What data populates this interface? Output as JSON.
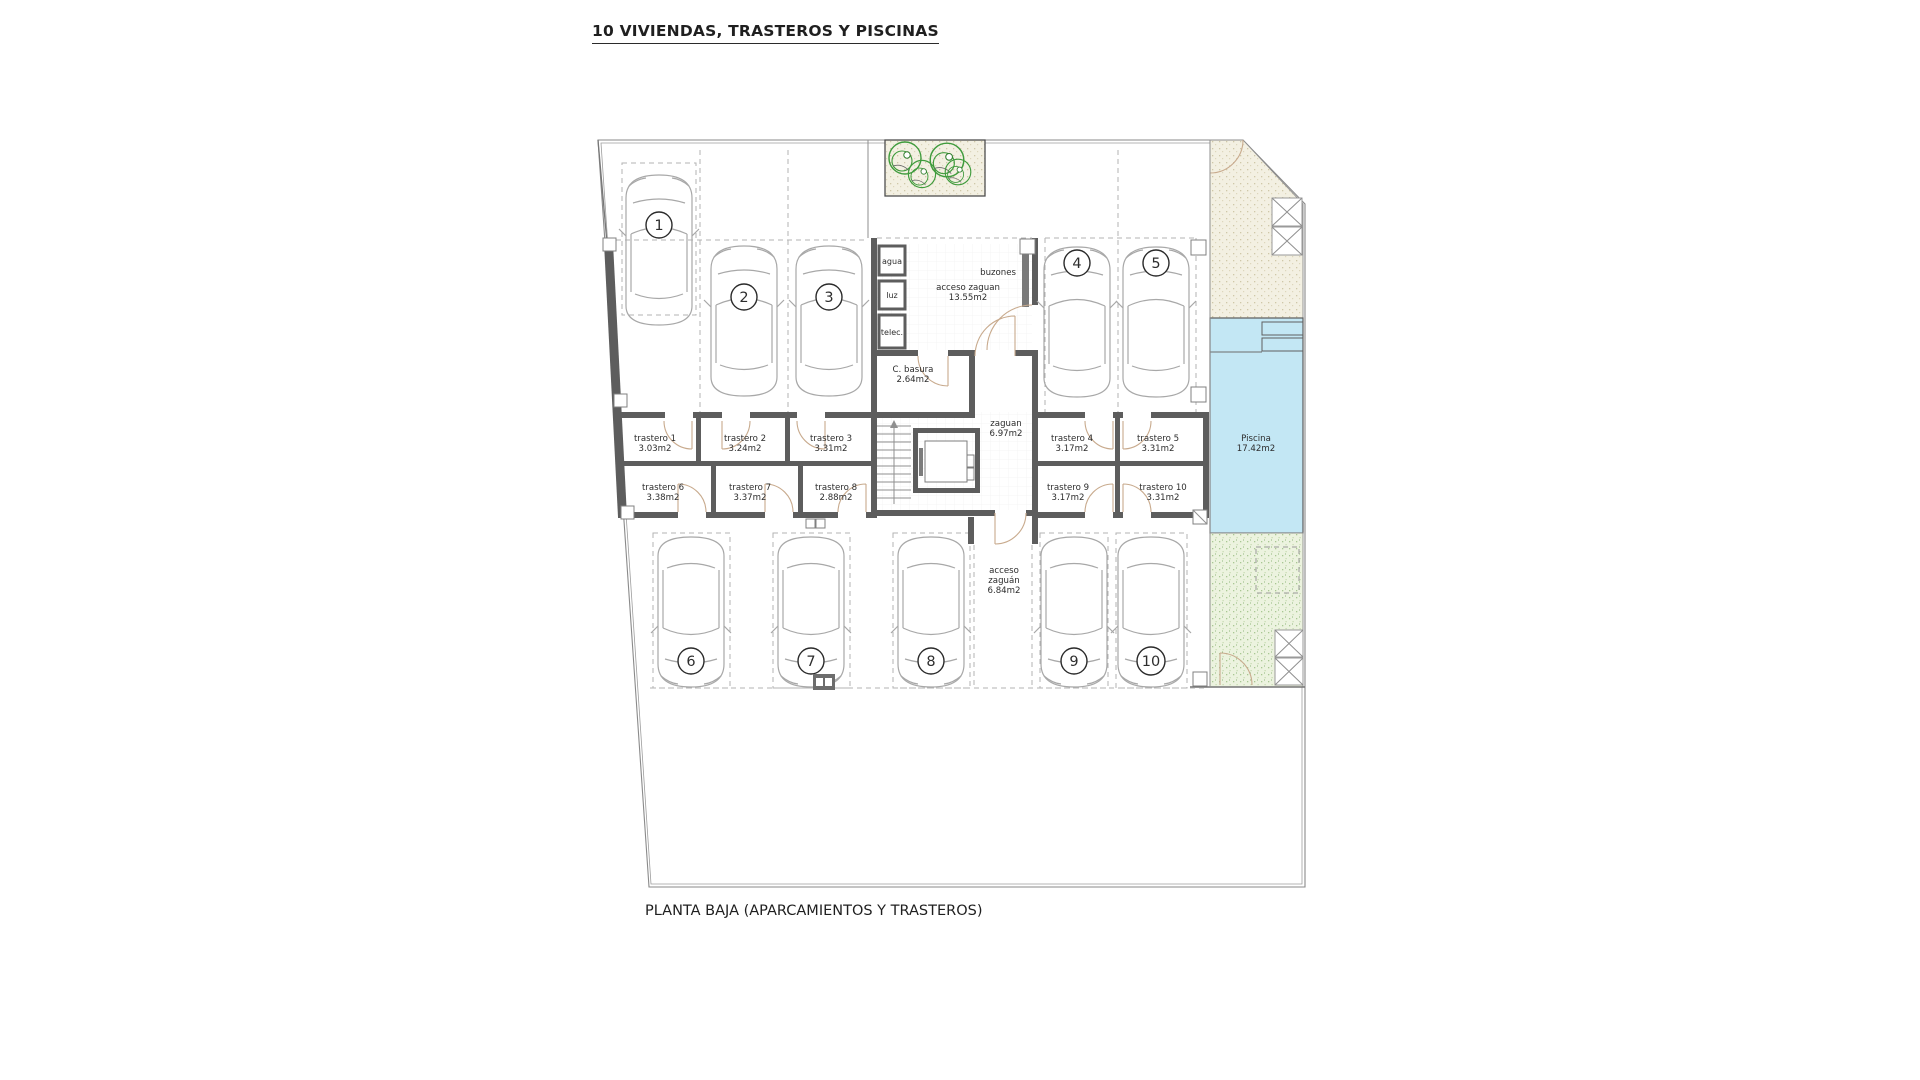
{
  "title": "10 VIVIENDAS, TRASTEROS Y PISCINAS",
  "caption": "PLANTA BAJA (APARCAMIENTOS Y TRASTEROS)",
  "colors": {
    "pool": "#c3e7f4",
    "garden_sand": "#f3f0e2",
    "garden_green": "#ebf2de",
    "wall": "#5d5d5d",
    "door": "#c8aa8d",
    "tree": "#3f9b3c"
  },
  "parking": [
    "1",
    "2",
    "3",
    "4",
    "5",
    "6",
    "7",
    "8",
    "9",
    "10"
  ],
  "trasteros": [
    {
      "name": "trastero 1",
      "area": "3.03m2"
    },
    {
      "name": "trastero 2",
      "area": "3.24m2"
    },
    {
      "name": "trastero 3",
      "area": "3.31m2"
    },
    {
      "name": "trastero 4",
      "area": "3.17m2"
    },
    {
      "name": "trastero 5",
      "area": "3.31m2"
    },
    {
      "name": "trastero 6",
      "area": "3.38m2"
    },
    {
      "name": "trastero 7",
      "area": "3.37m2"
    },
    {
      "name": "trastero 8",
      "area": "2.88m2"
    },
    {
      "name": "trastero 9",
      "area": "3.17m2"
    },
    {
      "name": "trastero 10",
      "area": "3.31m2"
    }
  ],
  "rooms": {
    "entrance": {
      "label": "acceso zaguan",
      "area": "13.55m2"
    },
    "basura": {
      "label": "C. basura",
      "area": "2.64m2"
    },
    "zaguan": {
      "label": "zaguan",
      "area": "6.97m2"
    },
    "south_access": {
      "l1": "acceso",
      "l2": "zaguán",
      "l3": "6.84m2"
    },
    "pool": {
      "label": "Piscina",
      "area": "17.42m2"
    },
    "buzones": "buzones",
    "utilities": [
      "agua",
      "luz",
      "telec."
    ]
  }
}
